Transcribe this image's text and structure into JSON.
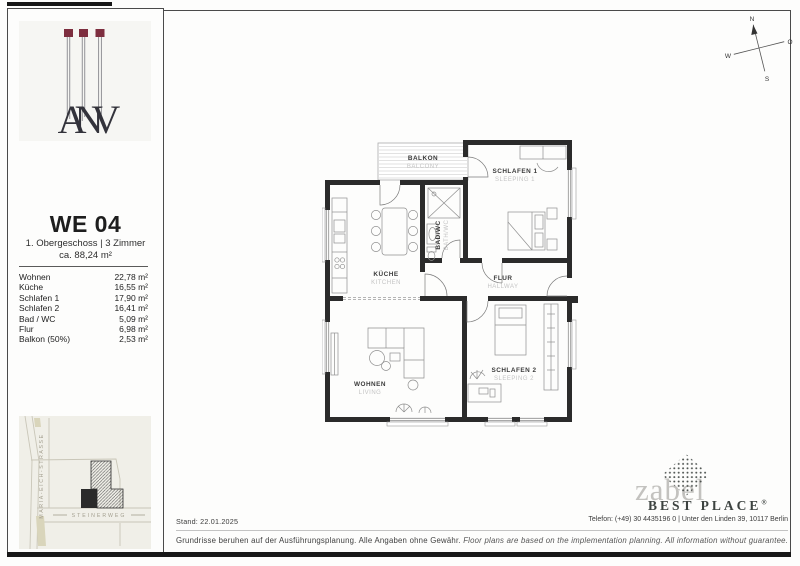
{
  "unit": {
    "code": "WE 04",
    "floor_rooms": "1. Obergeschoss | 3 Zimmer",
    "total_area": "ca. 88,24 m²"
  },
  "area_table": [
    {
      "label": "Wohnen",
      "value": "22,78 m²"
    },
    {
      "label": "Küche",
      "value": "16,55 m²"
    },
    {
      "label": "Schlafen 1",
      "value": "17,90 m²"
    },
    {
      "label": "Schlafen 2",
      "value": "16,41 m²"
    },
    {
      "label": "Bad / WC",
      "value": "5,09 m²"
    },
    {
      "label": "Flur",
      "value": "6,98 m²"
    },
    {
      "label": "Balkon (50%)",
      "value": "2,53 m²"
    }
  ],
  "logo": {
    "monogram": "ANV"
  },
  "map": {
    "street_vertical": "MARIA-EICH-STRASSE",
    "street_horizontal": "STEINERWEG"
  },
  "compass": {
    "north": "N",
    "east": "O",
    "south": "S",
    "west": "W"
  },
  "plan_rooms": {
    "balkon": {
      "de": "BALKON",
      "en": "BALCONY"
    },
    "schlafen1": {
      "de": "SCHLAFEN 1",
      "en": "SLEEPING 1"
    },
    "kueche": {
      "de": "KÜCHE",
      "en": "KITCHEN"
    },
    "bad": {
      "de": "BAD/WC",
      "en": "BATH/WC"
    },
    "flur": {
      "de": "FLUR",
      "en": "HALLWAY"
    },
    "wohnen": {
      "de": "WOHNEN",
      "en": "LIVING"
    },
    "schlafen2": {
      "de": "SCHLAFEN 2",
      "en": "SLEEPING 2"
    }
  },
  "footer": {
    "stand": "Stand: 22.01.2025",
    "contact": "Telefon: (+49) 30 4435196 0 | Unter den Linden 39, 10117 Berlin",
    "disclaimer_de": "Grundrisse beruhen auf der Ausführungsplanung. Alle Angaben ohne Gewähr.",
    "disclaimer_en": "Floor plans are based on the implementation planning. All information without guarantee."
  },
  "branding": {
    "zabel": "zabel",
    "best_place": "BEST PLACE",
    "registered": "®"
  },
  "colors": {
    "accent_maroon": "#7d2e3f",
    "wall": "#2b2b2b",
    "label_gray": "#c4c4c4",
    "map_bg": "#f0efe8"
  }
}
